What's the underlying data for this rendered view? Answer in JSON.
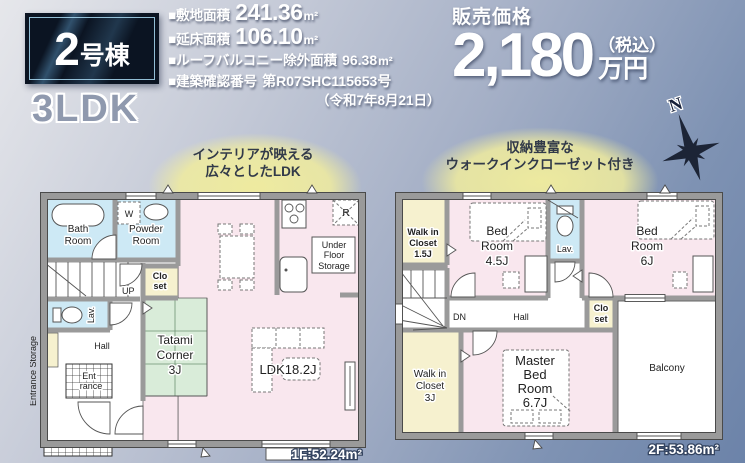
{
  "header": {
    "badge_number": "2",
    "badge_suffix": "号棟",
    "plan_type": "3LDK",
    "specs": [
      {
        "label": "■敷地面積",
        "value": "241.36",
        "unit": "m²"
      },
      {
        "label": "■延床面積",
        "value": "106.10",
        "unit": "m²"
      },
      {
        "label": "■ルーフバルコニー除外面積",
        "value": "96.38",
        "unit": "m²"
      },
      {
        "label": "■建築確認番号",
        "value": "第R07SHC115653号",
        "unit": ""
      }
    ],
    "spec_note": "（令和7年8月21日）",
    "price": {
      "label": "販売価格",
      "amount": "2,180",
      "tax": "（税込）",
      "unit": "万円"
    }
  },
  "annotations": {
    "ldk": {
      "line1": "インテリアが映える",
      "line2": "広々としたLDK"
    },
    "closet": {
      "line1": "収納豊富な",
      "line2": "ウォークインクローゼット付き"
    }
  },
  "compass": {
    "north": "N"
  },
  "colors": {
    "room_pink": "#f9e7ee",
    "room_blue": "#cde9f5",
    "room_cream": "#f6f1cf",
    "room_green": "#d9ecd9",
    "wall_gray": "#9a9a9a",
    "accent_navy": "#1c2436"
  },
  "floor1": {
    "area": "1F:52.24m²",
    "labels": {
      "bath": [
        "Bath",
        "Room"
      ],
      "powder": [
        "Powder",
        "Room"
      ],
      "washer": "W",
      "closet": [
        "Clo",
        "set"
      ],
      "up": "UP",
      "lav": "Lav.",
      "entrance_storage": "Entrance Storage",
      "hall": "Hall",
      "entrance": [
        "Ent",
        "rance"
      ],
      "tatami": [
        "Tatami",
        "Corner",
        "3J"
      ],
      "ldk": "LDK18.2J",
      "fridge": "R",
      "under_floor": [
        "Under",
        "Floor",
        "Storage"
      ]
    }
  },
  "floor2": {
    "area": "2F:53.86m²",
    "labels": {
      "wic_small": [
        "Walk in",
        "Closet",
        "1.5J"
      ],
      "bed45": [
        "Bed",
        "Room",
        "4.5J"
      ],
      "lav": "Lav.",
      "bed6": [
        "Bed",
        "Room",
        "6J"
      ],
      "dn": "DN",
      "hall": "Hall",
      "closet": [
        "Clo",
        "set"
      ],
      "wic_large": [
        "Walk in",
        "Closet",
        "3J"
      ],
      "master": [
        "Master",
        "Bed",
        "Room",
        "6.7J"
      ],
      "balcony": "Balcony"
    }
  }
}
